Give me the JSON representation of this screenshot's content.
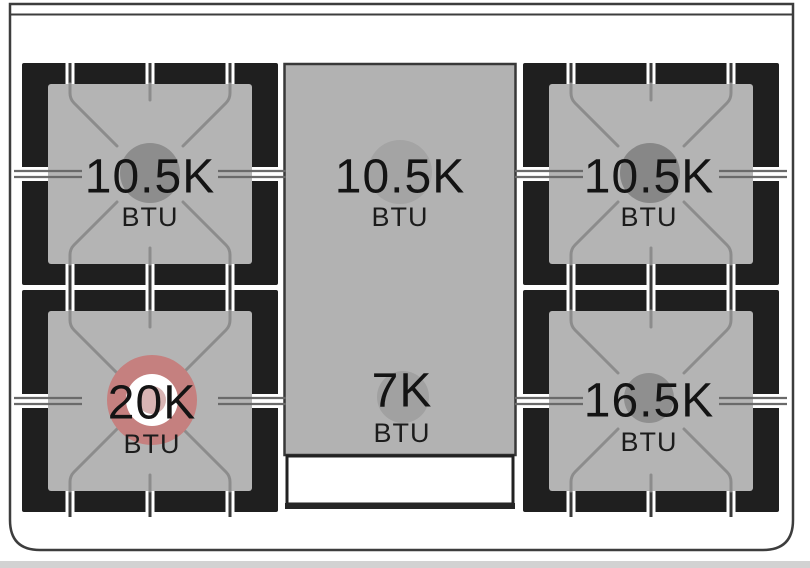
{
  "cooktop": {
    "description": "Range cooktop burner layout diagram with four grate burners and a center griddle section",
    "burners": [
      {
        "position": "top-left",
        "output": "10.5K",
        "unit": "BTU",
        "burner_color": "#8d8d8d"
      },
      {
        "position": "top-center",
        "output": "10.5K",
        "unit": "BTU",
        "burner_color": "#a4a4a4"
      },
      {
        "position": "top-right",
        "output": "10.5K",
        "unit": "BTU",
        "burner_color": "#878787"
      },
      {
        "position": "bottom-left",
        "output": "20K",
        "unit": "BTU",
        "burner_color": "#c5807f",
        "ring_color": "#ffffff",
        "inner_color": "#d8b4b3"
      },
      {
        "position": "bottom-center",
        "output": "7K",
        "unit": "BTU",
        "burner_color": "#a1a1a1"
      },
      {
        "position": "bottom-right",
        "output": "16.5K",
        "unit": "BTU",
        "burner_color": "#8f8f8f"
      }
    ],
    "colors": {
      "grate_black": "#1f1f1f",
      "surface_gray": "#b4b4b4",
      "outline_gray": "#3d3d3d",
      "accent_red": "#c5807f",
      "tray_white": "#ffffff"
    }
  }
}
